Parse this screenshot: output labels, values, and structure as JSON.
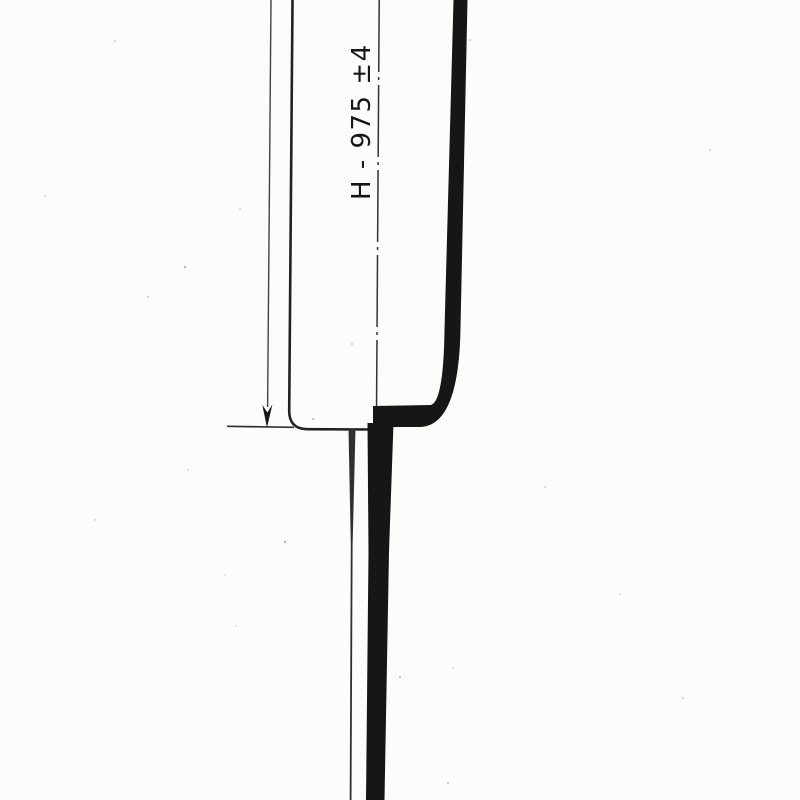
{
  "drawing": {
    "kind": "scanned technical drawing, pole section detail",
    "dimension": {
      "label": "H - 975 ±4",
      "name": "H",
      "value": "975",
      "tolerance": "±4"
    }
  },
  "colors": {
    "paper": "#fcfcfa",
    "ink": "#161616",
    "outline": "#222222",
    "line": "#303030",
    "dim_line": "#424242",
    "centerline": "#333333",
    "speckle": "#6f6f6f"
  }
}
